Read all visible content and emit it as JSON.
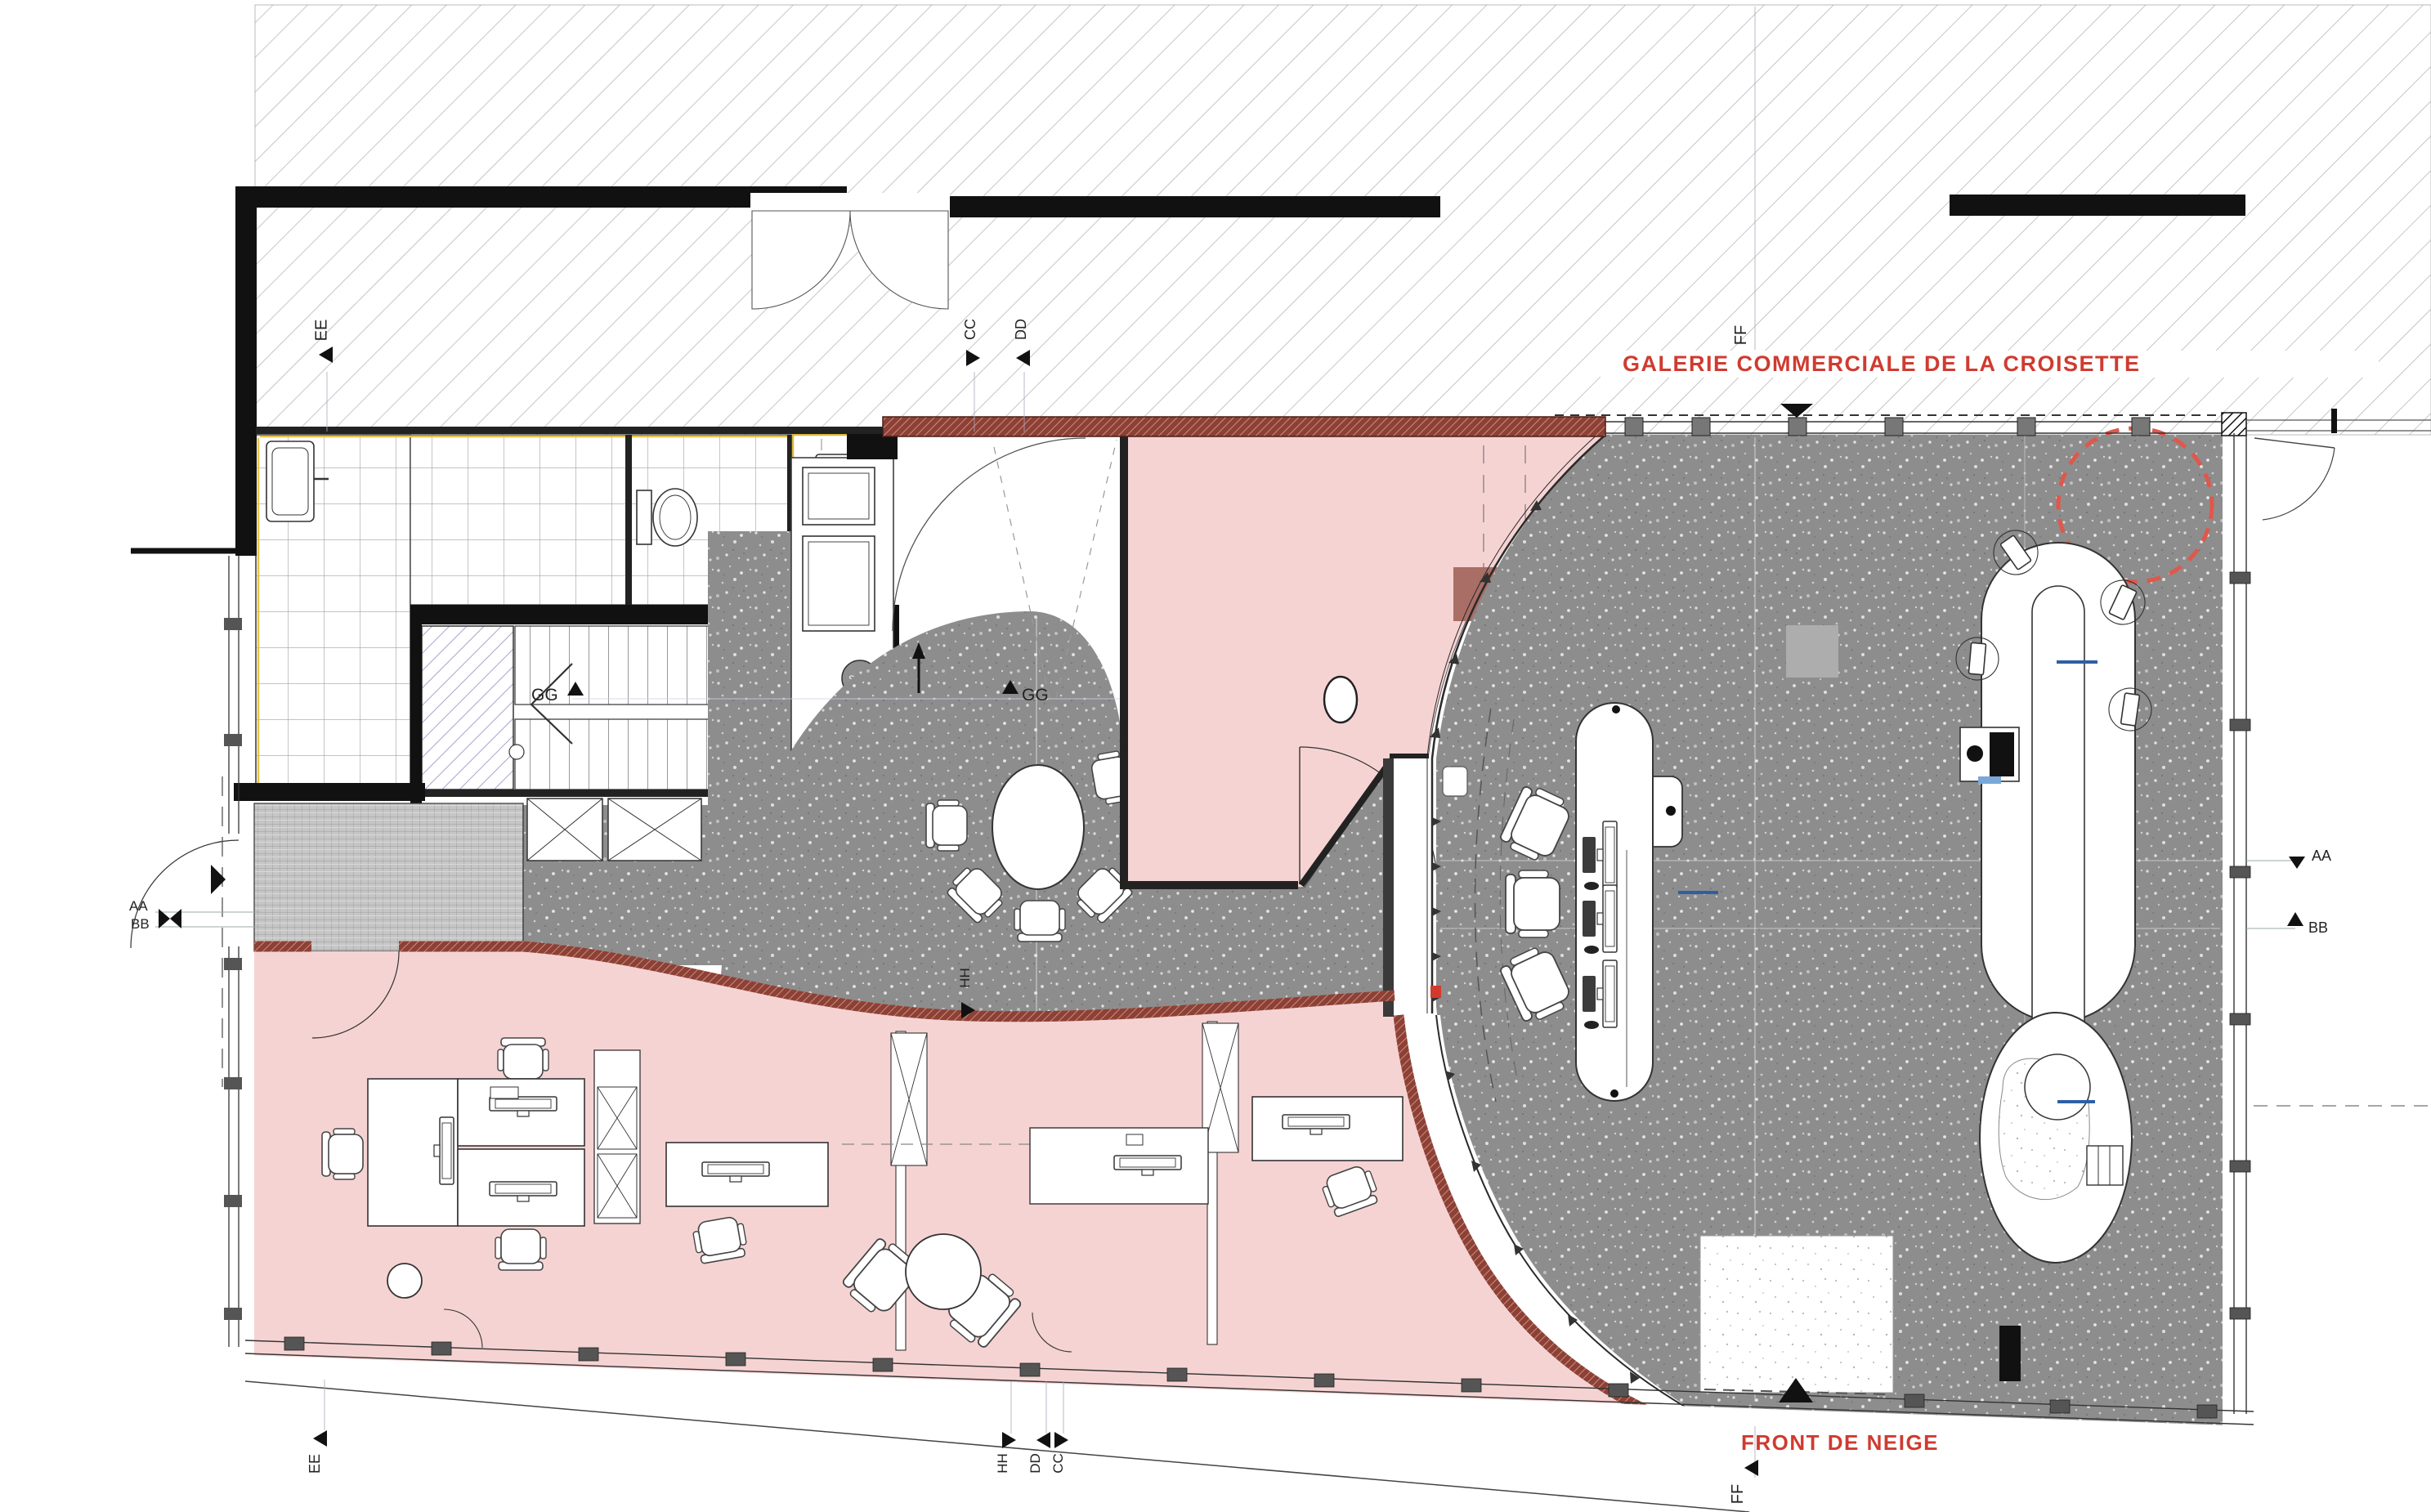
{
  "plan": {
    "galerie_label": "GALERIE COMMERCIALE DE LA CROISETTE",
    "front_label": "FRONT DE NEIGE"
  },
  "hvac": {
    "supply": "Souf.",
    "extract": "Asp."
  },
  "sections": {
    "aa": "AA",
    "bb": "BB",
    "cc": "CC",
    "dd": "DD",
    "ee": "EE",
    "ff": "FF",
    "gg": "GG",
    "hh": "HH"
  },
  "colors": {
    "label_red": "#cf3b30",
    "floor_gray": "#8d8d8d",
    "room_pink": "#f6d3d3",
    "wall_red_brown": "#8d4136",
    "lavender_hatch": "#a9a2cc",
    "accent_blue": "#2e5fa3",
    "accent_yellow": "#e6c34b",
    "dashed_circle_red": "#e0574b"
  }
}
